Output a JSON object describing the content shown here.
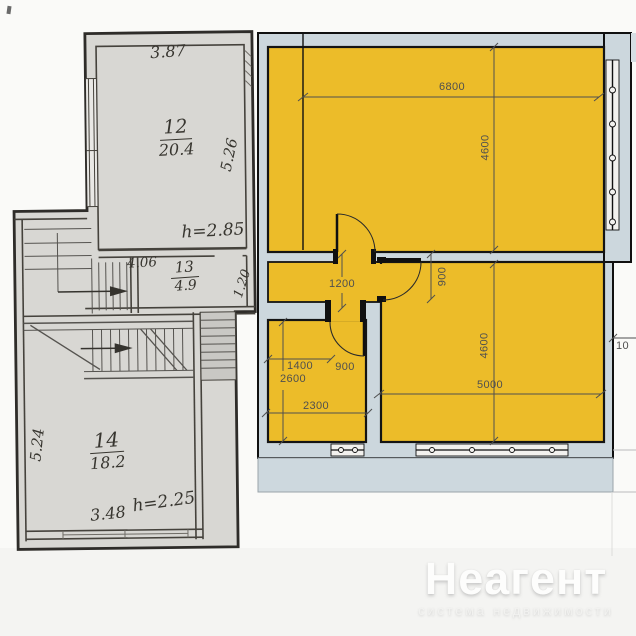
{
  "left_plan": {
    "rooms": [
      {
        "number": "12",
        "area": "20.4"
      },
      {
        "number": "13",
        "area": "4.9"
      },
      {
        "number": "14",
        "area": "18.2"
      }
    ],
    "dimensions": {
      "room12_width": "3.87",
      "room12_depth": "5.26",
      "ceiling_upper": "h=2.85",
      "room13_width": "4.06",
      "room13_depth": "1.20",
      "room14_depth": "5.24",
      "room14_width": "3.48",
      "ceiling_lower": "h=2.25"
    }
  },
  "right_plan": {
    "colors": {
      "room_fill": "#ecbc29",
      "wall_fill": "#ccd7dd",
      "outline": "#101010"
    },
    "dimensions": {
      "top_room_width": "6800",
      "top_room_depth": "4600",
      "top_door": "900",
      "hallway": "1200",
      "bottom_room_depth": "4600",
      "bottom_room_width": "5000",
      "small_room_width": "1400",
      "small_room_depth": "2600",
      "small_door": "900",
      "small_room_total": "2300",
      "edge_partial": "10"
    }
  },
  "watermark": {
    "title": "Неагент",
    "subtitle": "система недвижимости"
  }
}
